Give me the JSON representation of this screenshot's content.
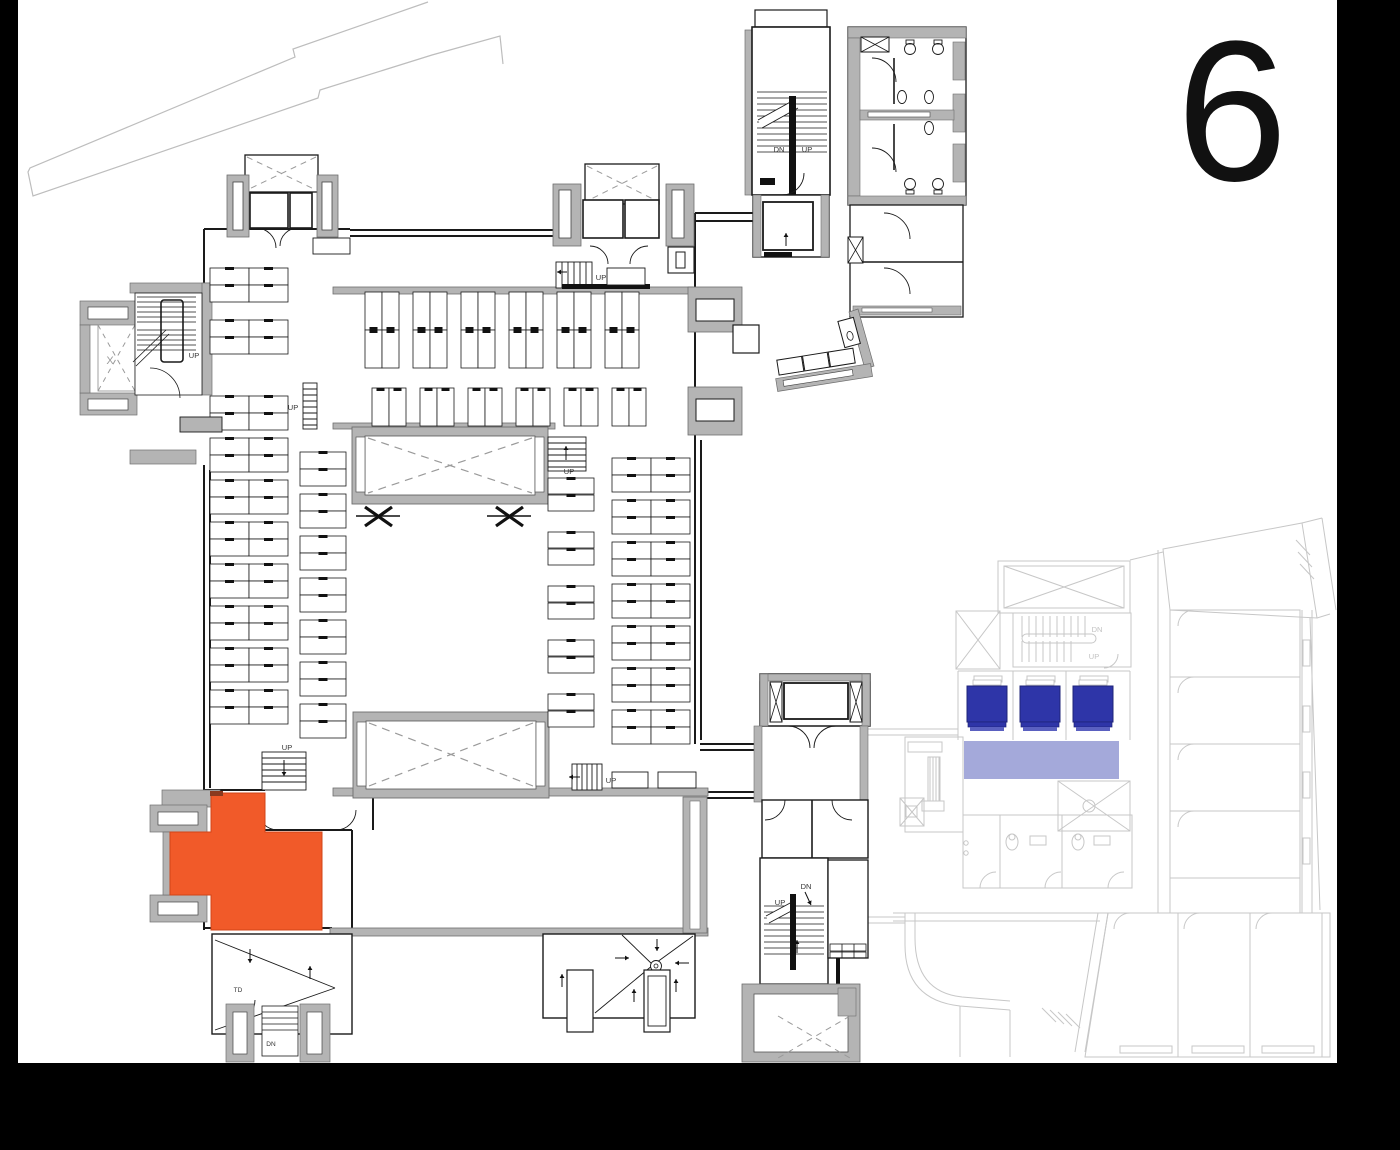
{
  "floor": {
    "number": "6"
  },
  "colors": {
    "wall": "#b4b4b4",
    "wall_edge": "#6e6e6e",
    "line": "#1a1a1a",
    "dash": "#9a9a9a",
    "faded": "#c7c7c7",
    "faded_text": "#c2c2c2",
    "highlight": "#f15a29",
    "highlight_door": "#8a3a1f",
    "bed": "#2e35a8",
    "bed_stripe": "#5a60c0",
    "overlay": "#9aa0d6",
    "frame": "#000000",
    "property_line": "#bdbdbd"
  },
  "highlighted_room": {
    "name": "selected-room",
    "points": "211,793 265,793 265,832 322,832 322,930 211,930 211,895 170,895 170,832 211,832"
  },
  "overlay_bar": {
    "x": 964,
    "y": 741,
    "w": 155,
    "h": 38
  },
  "beds": {
    "xs": [
      967,
      1020,
      1073
    ],
    "y": 686,
    "w": 40,
    "h": 36
  },
  "labels": [
    {
      "t": "DN",
      "x": 779,
      "y": 152,
      "s": 7.5,
      "name": "stair-dn-label"
    },
    {
      "t": "UP",
      "x": 807,
      "y": 152,
      "s": 7.5,
      "name": "stair-up-label"
    },
    {
      "t": "UP",
      "x": 194,
      "y": 358,
      "s": 7.5,
      "name": "stair-up-label"
    },
    {
      "t": "X",
      "x": 110,
      "y": 364,
      "s": 11,
      "c": "dash",
      "name": "balcony-x-label"
    },
    {
      "t": "UP",
      "x": 293,
      "y": 410,
      "s": 7.5,
      "name": "stair-up-label"
    },
    {
      "t": "UP",
      "x": 601,
      "y": 280,
      "s": 7.5,
      "name": "stair-up-label"
    },
    {
      "t": "UP",
      "x": 569,
      "y": 474,
      "s": 7.5,
      "name": "stair-up-label"
    },
    {
      "t": "UP",
      "x": 287,
      "y": 750,
      "s": 7.5,
      "name": "stair-up-label"
    },
    {
      "t": "UP",
      "x": 611,
      "y": 783,
      "s": 7.5,
      "name": "stair-up-label"
    },
    {
      "t": "UP",
      "x": 780,
      "y": 905,
      "s": 7.5,
      "name": "stair-up-label"
    },
    {
      "t": "DN",
      "x": 806,
      "y": 889,
      "s": 7.5,
      "name": "stair-dn-label"
    },
    {
      "t": "TD",
      "x": 238,
      "y": 992,
      "s": 6.5,
      "name": "td-label"
    },
    {
      "t": "DN",
      "x": 271,
      "y": 1046,
      "s": 6.5,
      "name": "stair-dn-label"
    },
    {
      "t": "DN",
      "x": 1097,
      "y": 632,
      "s": 7.5,
      "c": "faded_text",
      "name": "stair-dn-label-faded"
    },
    {
      "t": "UP",
      "x": 1094,
      "y": 659,
      "s": 7.5,
      "c": "faded_text",
      "name": "stair-up-label-faded"
    }
  ],
  "arrows": [
    {
      "x1": 786,
      "y1": 246,
      "x2": 786,
      "y2": 233
    },
    {
      "x1": 567,
      "y1": 272,
      "x2": 557,
      "y2": 272
    },
    {
      "x1": 566,
      "y1": 460,
      "x2": 566,
      "y2": 446
    },
    {
      "x1": 284,
      "y1": 760,
      "x2": 284,
      "y2": 776
    },
    {
      "x1": 580,
      "y1": 777,
      "x2": 569,
      "y2": 777
    },
    {
      "x1": 805,
      "y1": 892,
      "x2": 811,
      "y2": 905
    },
    {
      "x1": 797,
      "y1": 953,
      "x2": 797,
      "y2": 940
    },
    {
      "x1": 657,
      "y1": 939,
      "x2": 657,
      "y2": 951
    },
    {
      "x1": 615,
      "y1": 958,
      "x2": 629,
      "y2": 958
    },
    {
      "x1": 689,
      "y1": 963,
      "x2": 675,
      "y2": 963
    },
    {
      "x1": 562,
      "y1": 987,
      "x2": 562,
      "y2": 974
    },
    {
      "x1": 634,
      "y1": 1002,
      "x2": 634,
      "y2": 989
    },
    {
      "x1": 676,
      "y1": 992,
      "x2": 676,
      "y2": 979
    },
    {
      "x1": 250,
      "y1": 949,
      "x2": 250,
      "y2": 963
    },
    {
      "x1": 310,
      "y1": 979,
      "x2": 310,
      "y2": 966
    }
  ],
  "desk_groups": [
    {
      "name": "north-desks-double-row",
      "orient": "v",
      "xs": [
        365,
        413,
        461,
        509,
        557,
        605
      ],
      "ys": [
        292,
        330
      ],
      "dw": 17,
      "dh": 38,
      "per": 2
    },
    {
      "name": "north-desks-single-row",
      "orient": "v",
      "xs": [
        372,
        420,
        468,
        516,
        564,
        612
      ],
      "ys": [
        388
      ],
      "dw": 17,
      "dh": 38,
      "per": 2
    },
    {
      "name": "west-desk-pairs",
      "orient": "h",
      "xs": [
        210
      ],
      "ys": [
        268,
        285,
        320,
        337,
        396,
        413,
        438,
        455,
        480,
        497,
        522,
        539,
        564,
        581,
        606,
        623,
        648,
        665,
        690,
        707
      ],
      "dw": 39,
      "dh": 17,
      "per": 2
    },
    {
      "name": "west-inner-desks",
      "orient": "h",
      "xs": [
        300
      ],
      "ys": [
        452,
        469,
        494,
        511,
        536,
        553,
        578,
        595,
        620,
        637,
        662,
        679,
        704,
        721
      ],
      "dw": 46,
      "dh": 17,
      "per": 1
    },
    {
      "name": "east-desk-pairs",
      "orient": "h",
      "xs": [
        612
      ],
      "ys": [
        458,
        475,
        500,
        517,
        542,
        559,
        584,
        601,
        626,
        643,
        668,
        685,
        710,
        727
      ],
      "dw": 39,
      "dh": 17,
      "per": 2
    },
    {
      "name": "mid-desks",
      "orient": "h",
      "xs": [
        548
      ],
      "ys": [
        478,
        495,
        532,
        549,
        586,
        603,
        640,
        657,
        694,
        711
      ],
      "dw": 46,
      "dh": 16,
      "per": 1
    }
  ],
  "tables": [
    {
      "x": 612,
      "y": 772,
      "w": 36,
      "h": 16
    },
    {
      "x": 658,
      "y": 772,
      "w": 38,
      "h": 16
    },
    {
      "x": 607,
      "y": 268,
      "w": 38,
      "h": 17
    },
    {
      "x": 313,
      "y": 238,
      "w": 37,
      "h": 16
    },
    {
      "x": 180,
      "y": 417,
      "w": 42,
      "h": 15,
      "fill": "wall"
    }
  ]
}
